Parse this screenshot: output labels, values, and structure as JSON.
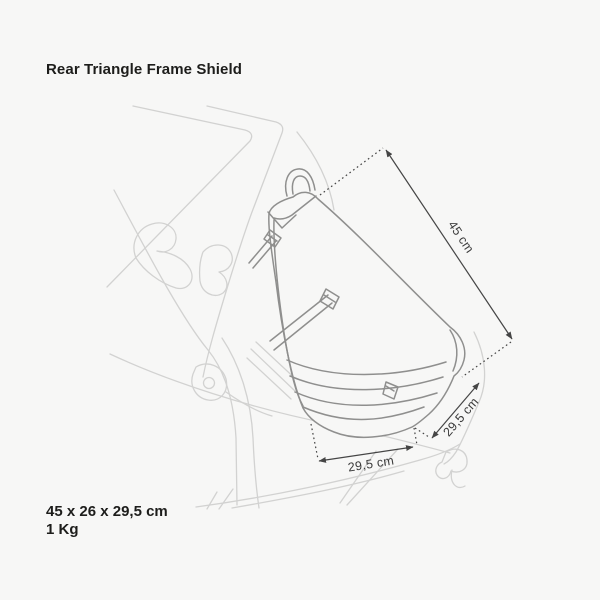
{
  "title": "Rear Triangle Frame Shield",
  "specs": {
    "dimensions": "45 x 26 x 29,5 cm",
    "weight": "1 Kg"
  },
  "diagram": {
    "product": "rear-triangle-frame-shield-bag-on-bike-frame",
    "labels": {
      "length": "45 cm",
      "depth": "29,5 cm",
      "width": "29,5 cm"
    }
  },
  "colors": {
    "background": "#f7f7f6",
    "bike_line_art": "#d2d2d1",
    "product_line_art": "#8f8f8e",
    "dimension_lines": "#454545",
    "text": "#1d1d1b"
  }
}
